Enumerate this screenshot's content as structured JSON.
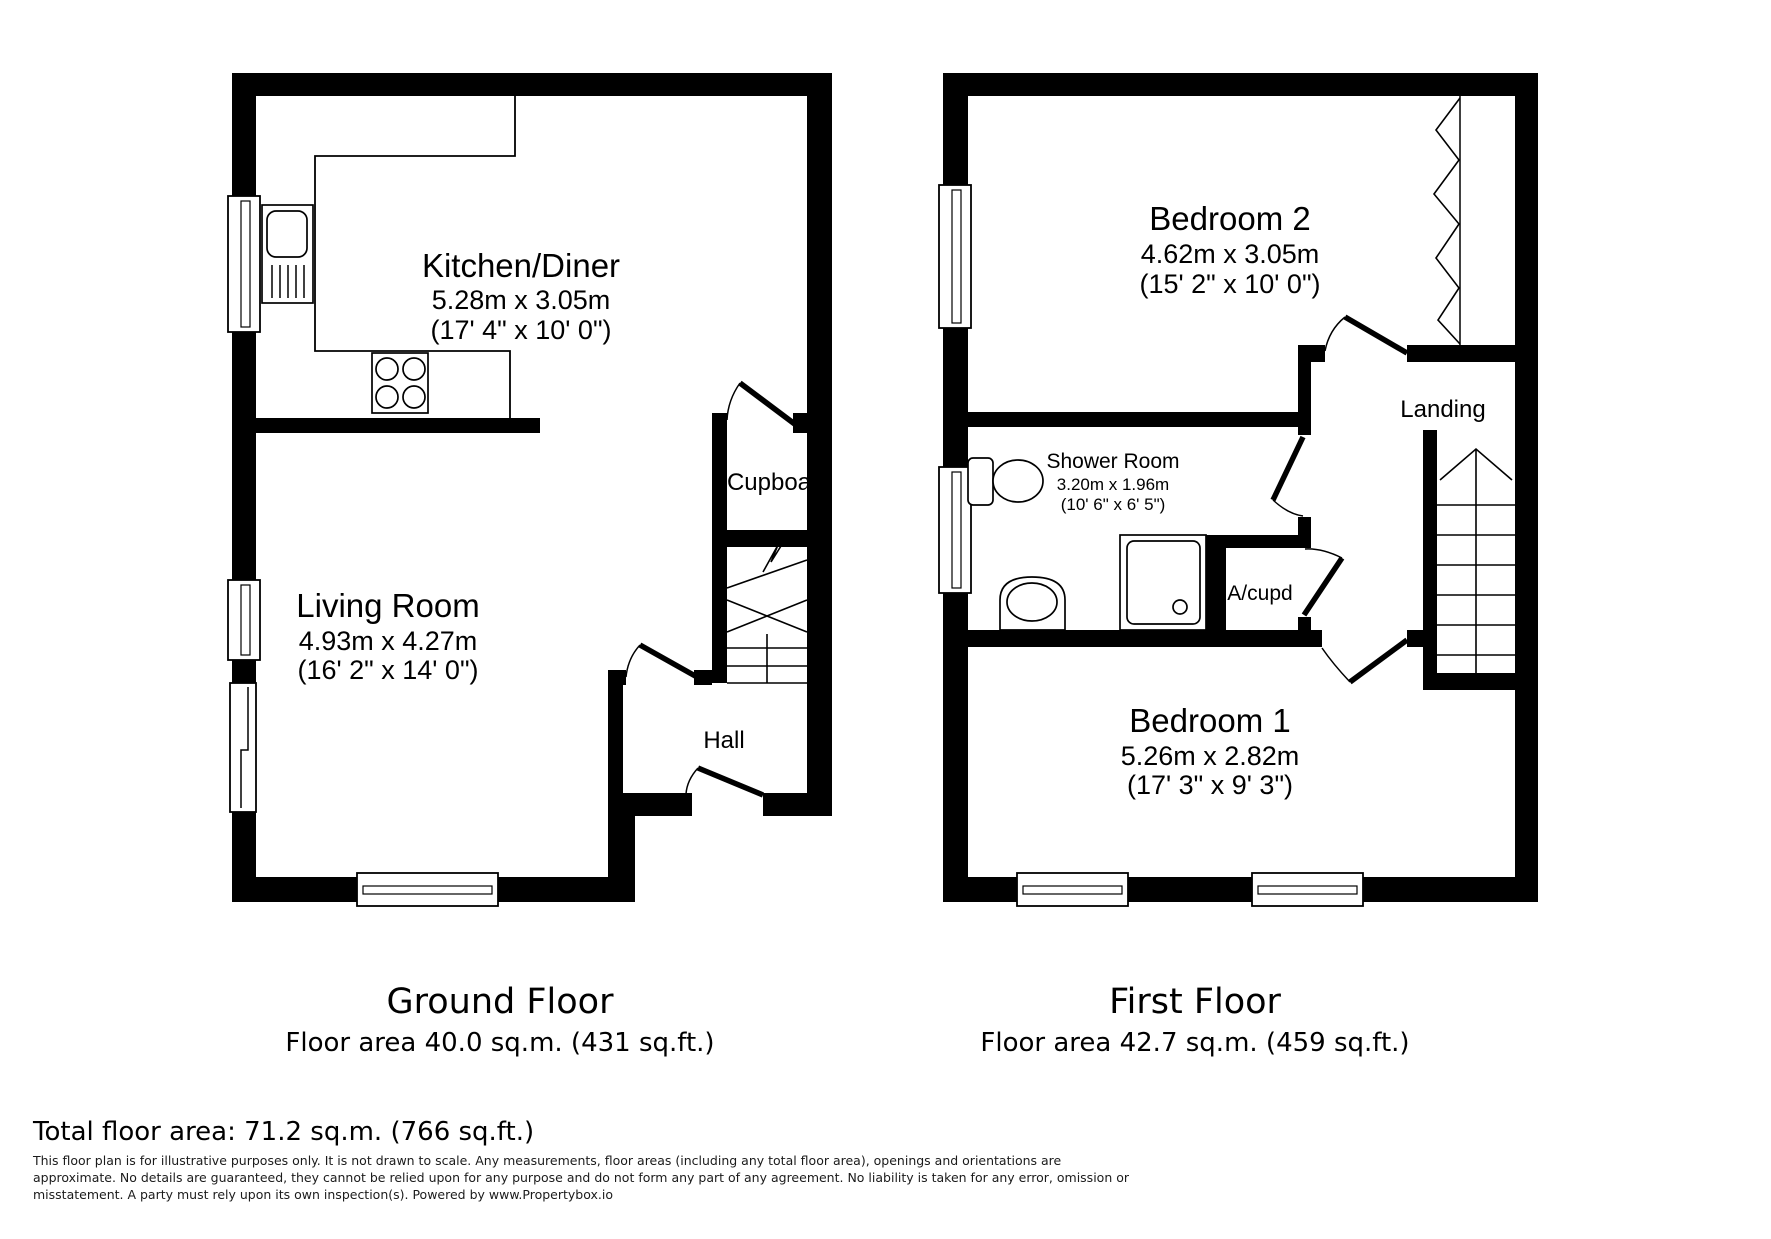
{
  "doc": {
    "background": "#ffffff",
    "wall_color": "#000000"
  },
  "ground_floor": {
    "caption_title": "Ground Floor",
    "caption_area": "Floor area 40.0 sq.m. (431 sq.ft.)",
    "rooms": {
      "kitchen": {
        "name": "Kitchen/Diner",
        "dims_m": "5.28m x 3.05m",
        "dims_ft": "(17' 4\" x 10' 0\")"
      },
      "living": {
        "name": "Living Room",
        "dims_m": "4.93m x 4.27m",
        "dims_ft": "(16' 2\" x 14' 0\")"
      },
      "cupboard": {
        "name": "Cupboa"
      },
      "hall": {
        "name": "Hall"
      }
    }
  },
  "first_floor": {
    "caption_title": "First Floor",
    "caption_area": "Floor area 42.7 sq.m. (459 sq.ft.)",
    "rooms": {
      "bedroom2": {
        "name": "Bedroom 2",
        "dims_m": "4.62m x 3.05m",
        "dims_ft": "(15' 2\" x 10' 0\")"
      },
      "shower": {
        "name": "Shower Room",
        "dims_m": "3.20m x 1.96m",
        "dims_ft": "(10' 6\" x 6' 5\")"
      },
      "landing": {
        "name": "Landing"
      },
      "acupd": {
        "name": "A/cupd"
      },
      "bedroom1": {
        "name": "Bedroom 1",
        "dims_m": "5.26m x 2.82m",
        "dims_ft": "(17' 3\" x 9' 3\")"
      }
    }
  },
  "summary": {
    "total": "Total floor area: 71.2 sq.m. (766 sq.ft.)"
  },
  "disclaimer": {
    "line1": "This floor plan is for illustrative purposes only. It is not drawn to scale. Any measurements, floor areas (including any total floor area), openings and orientations are",
    "line2": "approximate. No details are guaranteed, they cannot be relied upon for any purpose and do not form any part of any agreement. No liability is taken for any error, omission or",
    "line3": "misstatement. A party must rely upon its own inspection(s). Powered by www.Propertybox.io"
  }
}
